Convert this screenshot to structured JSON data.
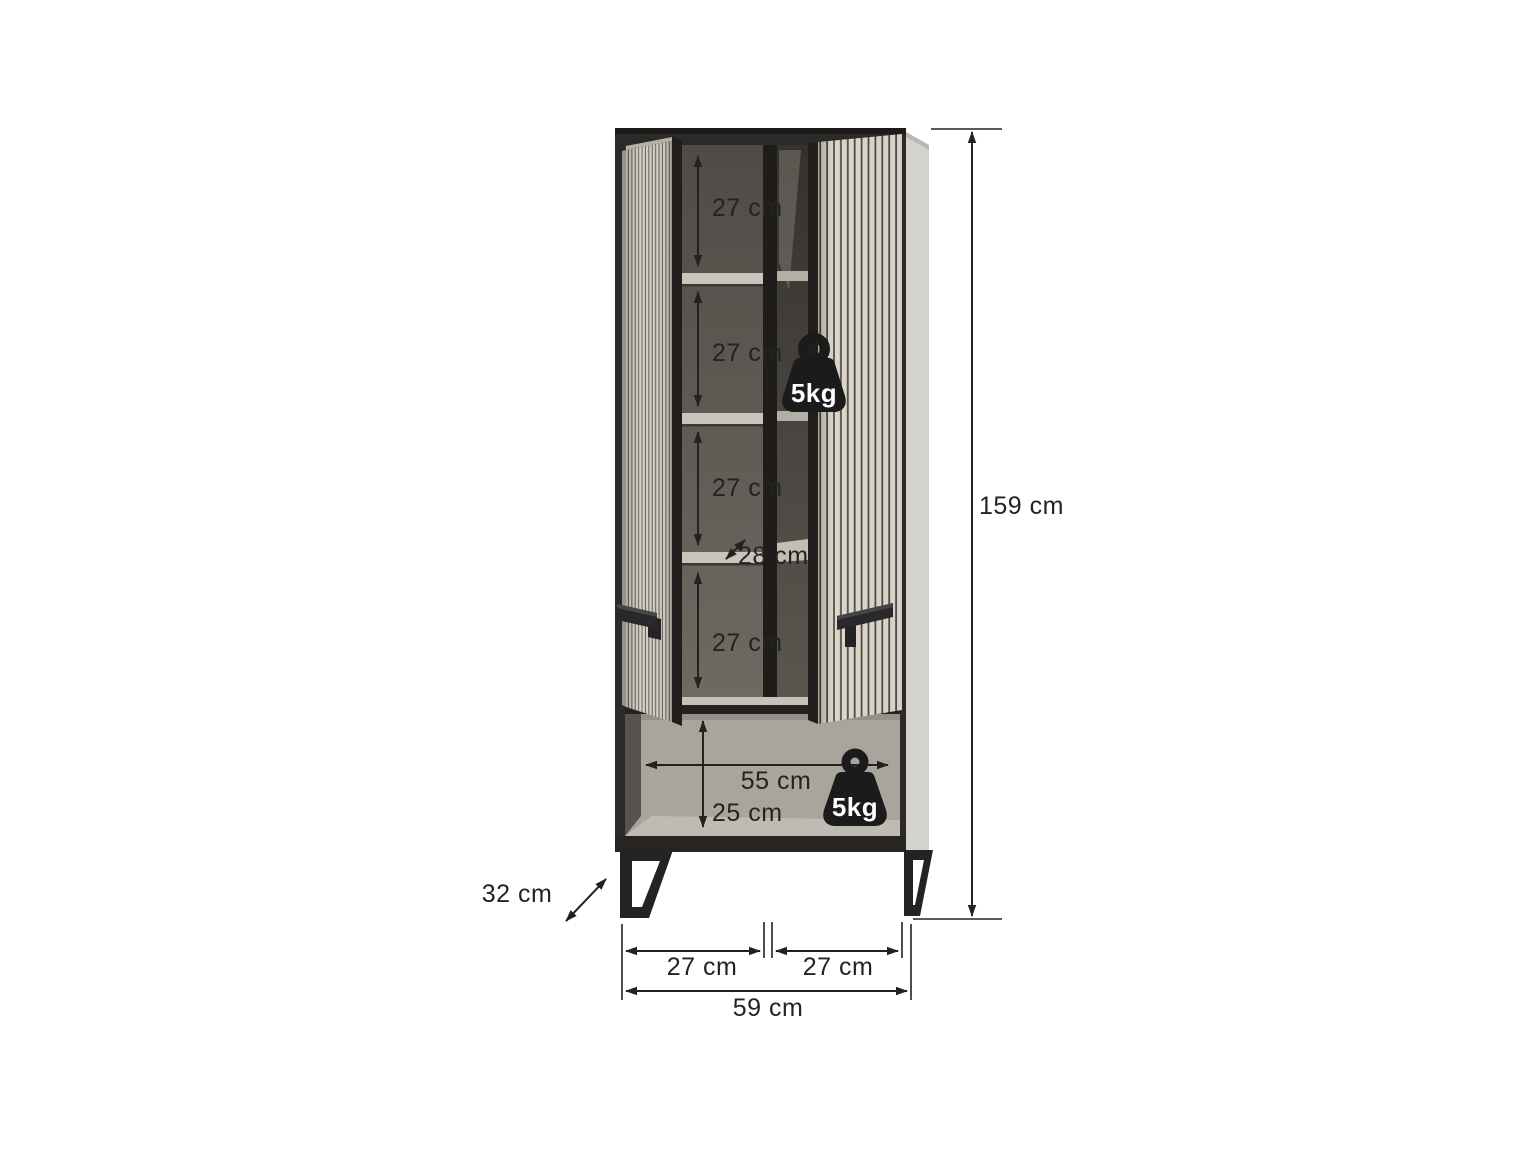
{
  "diagram": {
    "kind": "furniture-dimension-diagram",
    "unit": "cm",
    "labels": {
      "inner_h1": "27 cm",
      "inner_h2": "27 cm",
      "inner_h3": "27 cm",
      "shelf_depth": "28 cm",
      "inner_h4": "27 cm",
      "total_height": "159 cm",
      "niche_width": "55 cm",
      "niche_height": "25 cm",
      "depth": "32 cm",
      "base_span_left": "27 cm",
      "base_span_right": "27 cm",
      "total_width": "59 cm"
    },
    "load_badges": {
      "shelf": "5kg",
      "niche": "5kg"
    },
    "colors": {
      "background": "#ffffff",
      "frame_black": "#2b2a28",
      "slat_cream": "#d9d3c7",
      "slat_gap": "#5d5951",
      "side_panel": "#d5d3ce",
      "interior_gray": "#625e57",
      "shelf_light": "#c9c5bd",
      "niche_gray": "#a9a59d",
      "annotation": "#232220",
      "badge_black": "#1b1b1b"
    }
  }
}
